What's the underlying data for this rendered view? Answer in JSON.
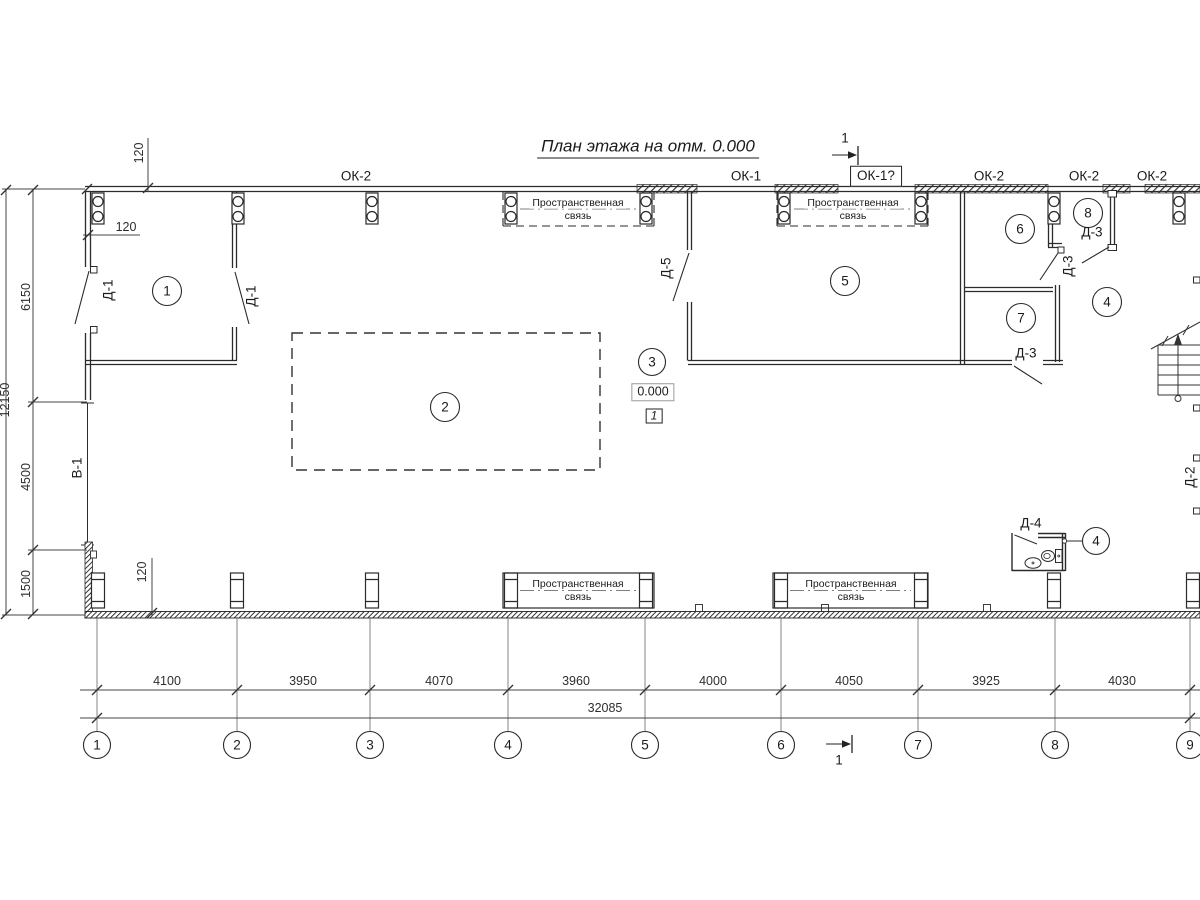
{
  "title": "План этажа на отм. 0.000",
  "section_marks": {
    "top": "1",
    "bottom": "1"
  },
  "windows": {
    "ok2_left": "ОК-2",
    "ok1": "ОК-1",
    "ok1_q": "ОК-1?",
    "ok2_a": "ОК-2",
    "ok2_b": "ОК-2",
    "ok2_c": "ОК-2"
  },
  "rooms": {
    "n1": "1",
    "n2": "2",
    "n3": "3",
    "n4": "4",
    "n5": "5",
    "n6": "6",
    "n7": "7",
    "n8": "8",
    "wc_callout": "4"
  },
  "doors": {
    "d1_left": "Д-1",
    "d1_right": "Д-1",
    "d5": "Д-5",
    "d3_a": "Д-3",
    "d3_b": "Д-3",
    "d3_c": "Д-3",
    "d4": "Д-4",
    "d2": "Д-2",
    "v1": "В-1"
  },
  "spatial_tie": {
    "line1": "Пространственная",
    "line2": "связь"
  },
  "elevation": {
    "value": "0.000",
    "node": "1"
  },
  "dimensions": {
    "left": {
      "total": "12150",
      "segments": [
        "6150",
        "4500",
        "1500"
      ]
    },
    "bottom": {
      "segments": [
        "4100",
        "3950",
        "4070",
        "3960",
        "4000",
        "4050",
        "3925",
        "4030"
      ],
      "total": "32085"
    },
    "offsets": {
      "top": "120",
      "left": "120",
      "bottom": "120"
    }
  },
  "grid": {
    "axes": [
      "1",
      "2",
      "3",
      "4",
      "5",
      "6",
      "7",
      "8",
      "9"
    ]
  }
}
